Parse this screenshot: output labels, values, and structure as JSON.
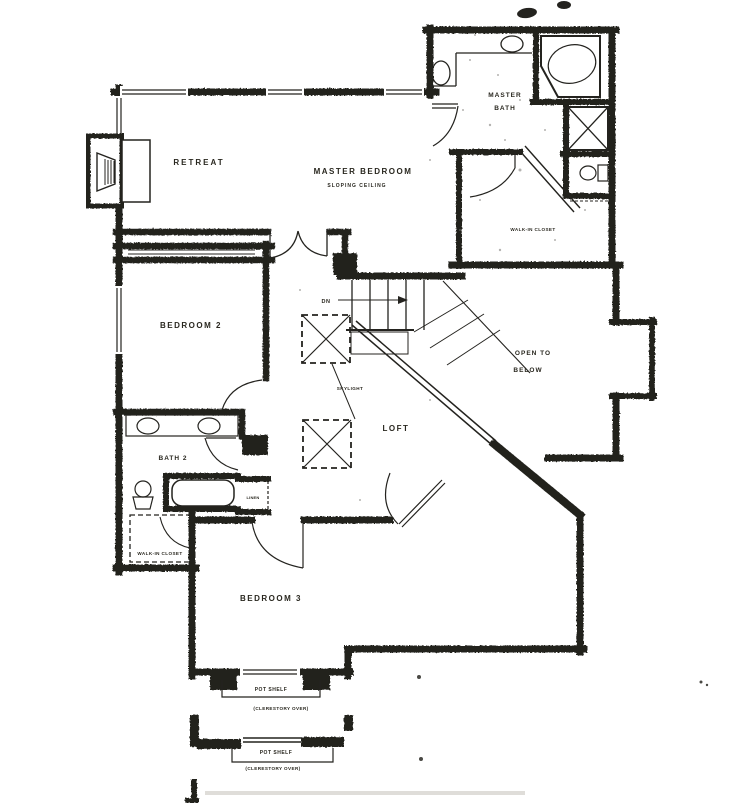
{
  "labels": {
    "retreat": "RETREAT",
    "master_bedroom": "MASTER BEDROOM",
    "master_bedroom_note": "SLOPING CEILING",
    "master_bath_1": "MASTER",
    "master_bath_2": "BATH",
    "walk_in_closet_master": "WALK-IN CLOSET",
    "bedroom_2": "BEDROOM 2",
    "stairs_dn": "DN",
    "skylight": "SKYLIGHT",
    "loft": "LOFT",
    "open_to_below_1": "OPEN TO",
    "open_to_below_2": "BELOW",
    "bath_2": "BATH 2",
    "linen": "LINEN",
    "walk_in_closet_2": "WALK-IN CLOSET",
    "bedroom_3": "BEDROOM 3",
    "pot_shelf_upper": "POT SHELF",
    "clerestory_upper": "(CLERESTORY OVER)",
    "pot_shelf_lower": "POT SHELF",
    "clerestory_lower": "(CLERESTORY OVER)"
  },
  "colors": {
    "ink": "#24231f",
    "paper": "#ffffff",
    "speckle": "#6b6b66",
    "smudge": "#c9c7c0"
  }
}
